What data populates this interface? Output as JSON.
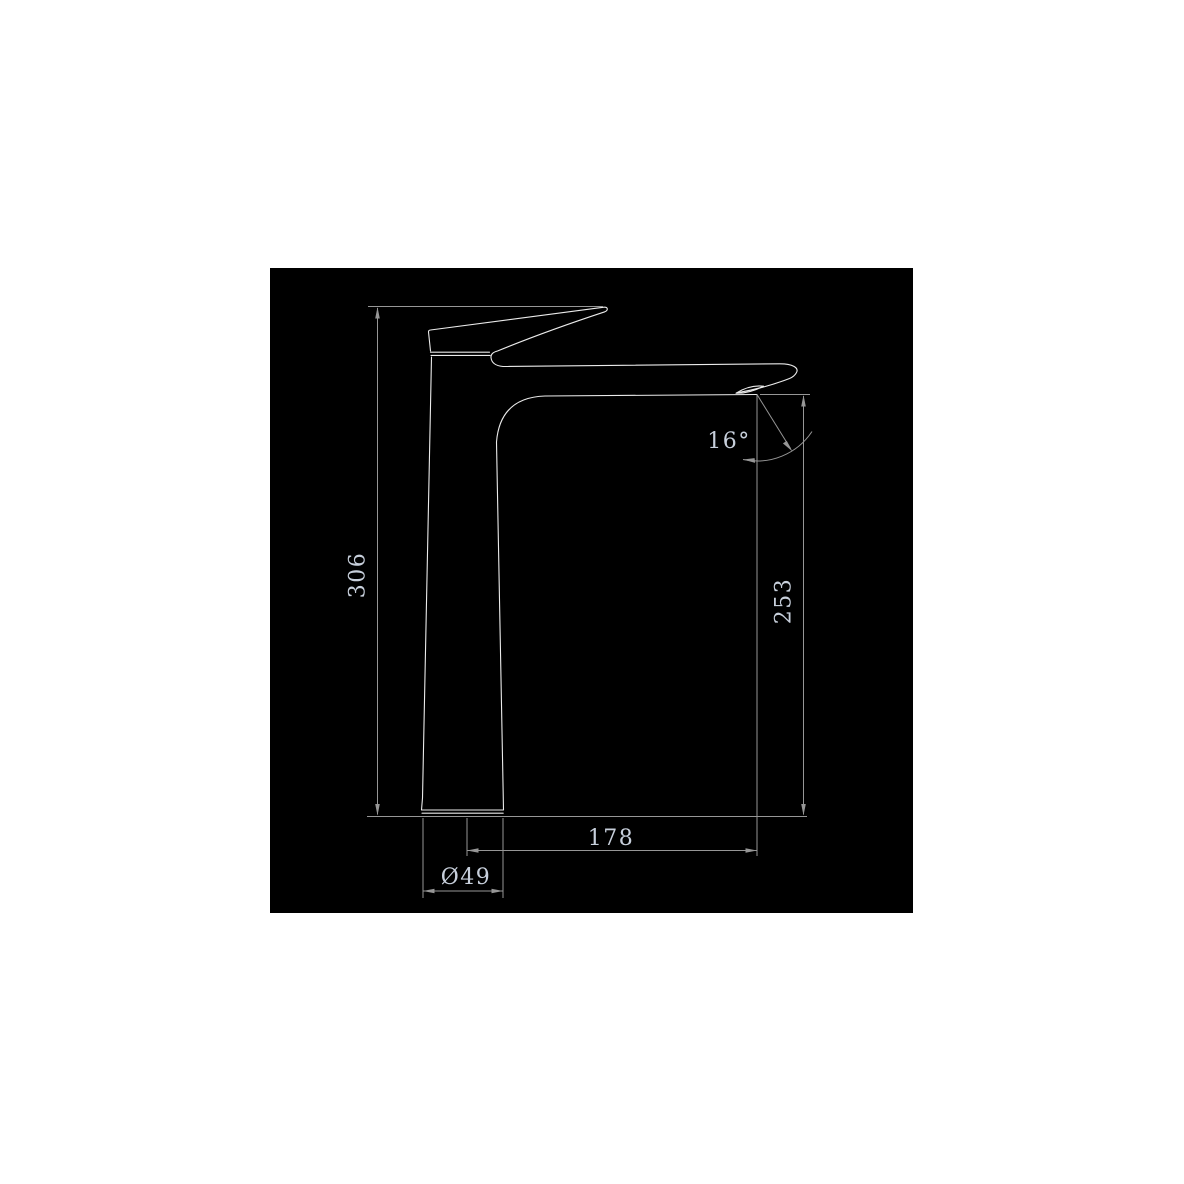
{
  "drawing": {
    "labels": {
      "height_total": "306",
      "height_spout": "253",
      "reach": "178",
      "base_diameter": "Ø49",
      "spout_angle": "16°"
    },
    "colors": {
      "page_background": "#ffffff",
      "panel_background": "#000000",
      "outline": "#ebebeb",
      "dimension": "#969696",
      "label_text": "#c7cfdb"
    }
  }
}
